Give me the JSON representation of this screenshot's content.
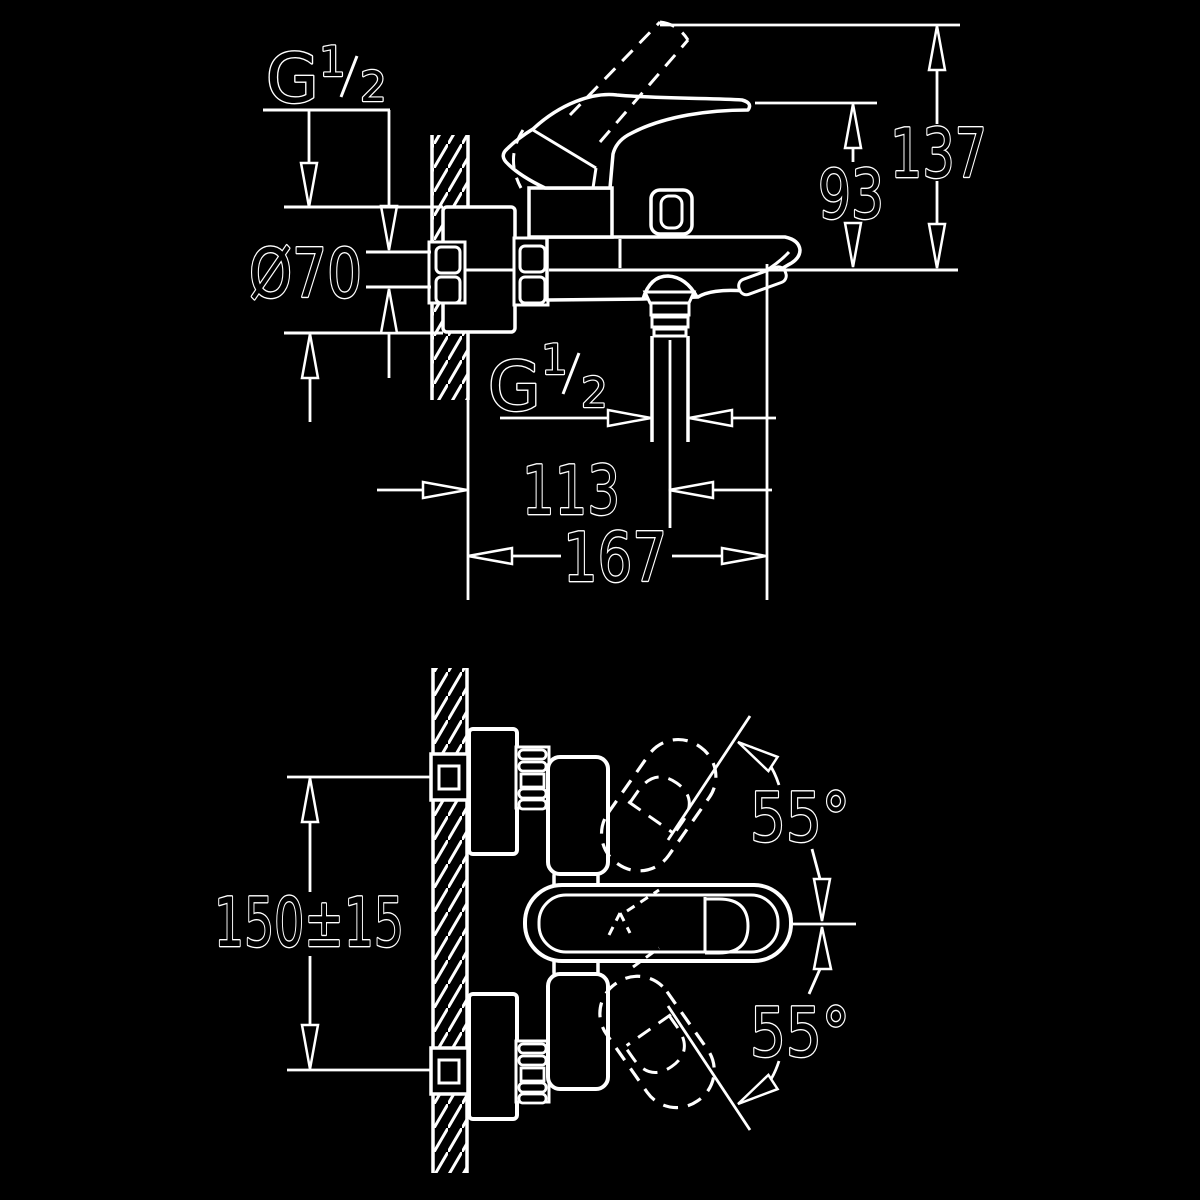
{
  "title": "Wall-mounted single-lever bath mixer — installation dimension drawing",
  "colors": {
    "background": "#000000",
    "line": "#ffffff"
  },
  "side_view": {
    "inlet_thread": {
      "letter": "G",
      "numerator": "1",
      "denominator": "2"
    },
    "flange_diameter": "Ø70",
    "lever_height": "93",
    "total_height": "137",
    "outlet_thread": {
      "letter": "G",
      "numerator": "1",
      "denominator": "2"
    },
    "wall_to_outlet": "113",
    "projection": "167"
  },
  "front_view": {
    "pipe_spacing": "150±15",
    "swing_upper": "55°",
    "swing_lower": "55°"
  }
}
